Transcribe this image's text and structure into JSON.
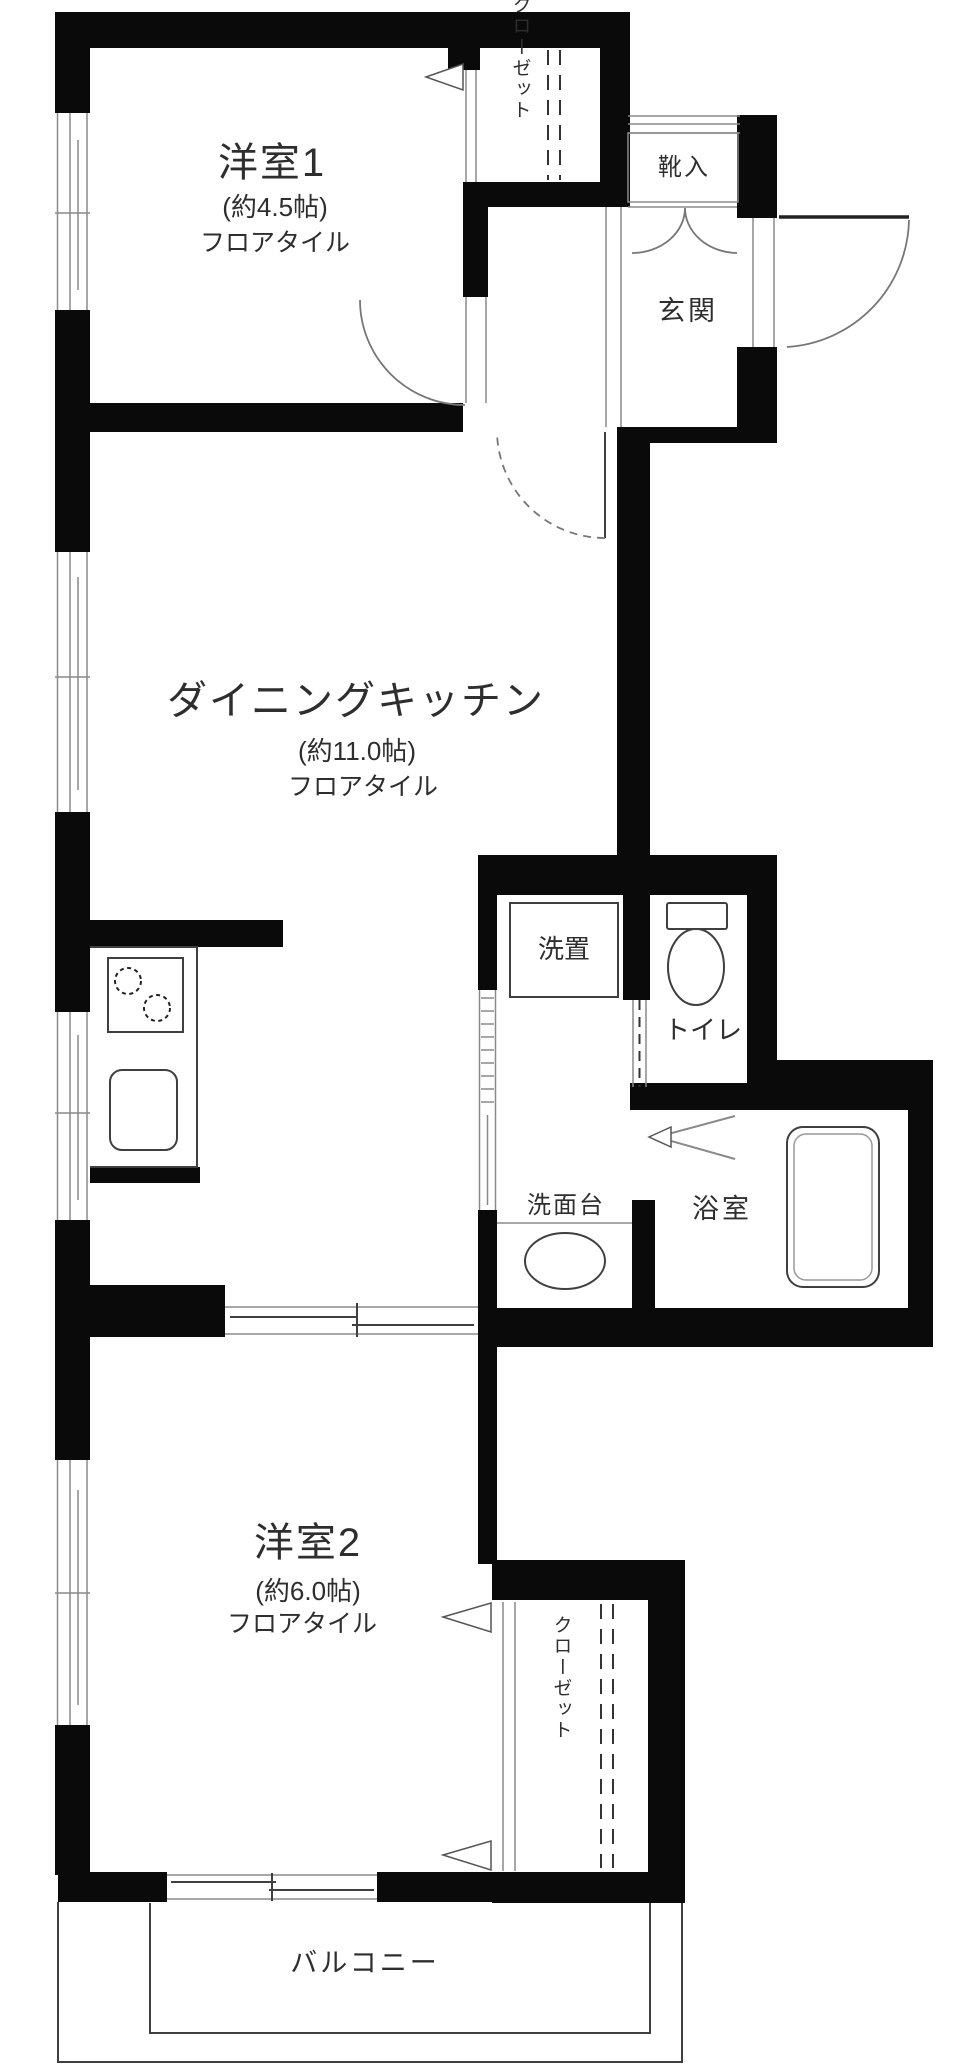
{
  "meta": {
    "type": "floorplan",
    "description": "Japanese apartment floor plan, 2DK layout with balcony"
  },
  "colors": {
    "wall": "#0a0a0a",
    "line": "#8a8a8a",
    "linedark": "#3f3f3f",
    "text": "#2e2e2e",
    "bg": "#ffffff"
  },
  "rooms": {
    "room1": {
      "name": "洋室1",
      "size": "(約4.5帖)",
      "floor": "フロアタイル"
    },
    "dk": {
      "name": "ダイニングキッチン",
      "size": "(約11.0帖)",
      "floor": "フロアタイル"
    },
    "room2": {
      "name": "洋室2",
      "size": "(約6.0帖)",
      "floor": "フロアタイル"
    },
    "entrance": {
      "name": "玄関"
    },
    "shoe_cabinet": {
      "name": "靴入"
    },
    "closet_top": {
      "name": "クローゼット"
    },
    "closet_bottom": {
      "name": "クローゼット"
    },
    "laundry": {
      "name": "洗置"
    },
    "toilet": {
      "name": "トイレ"
    },
    "bathroom": {
      "name": "浴室"
    },
    "washstand": {
      "name": "洗面台"
    },
    "balcony": {
      "name": "バルコニー"
    }
  }
}
